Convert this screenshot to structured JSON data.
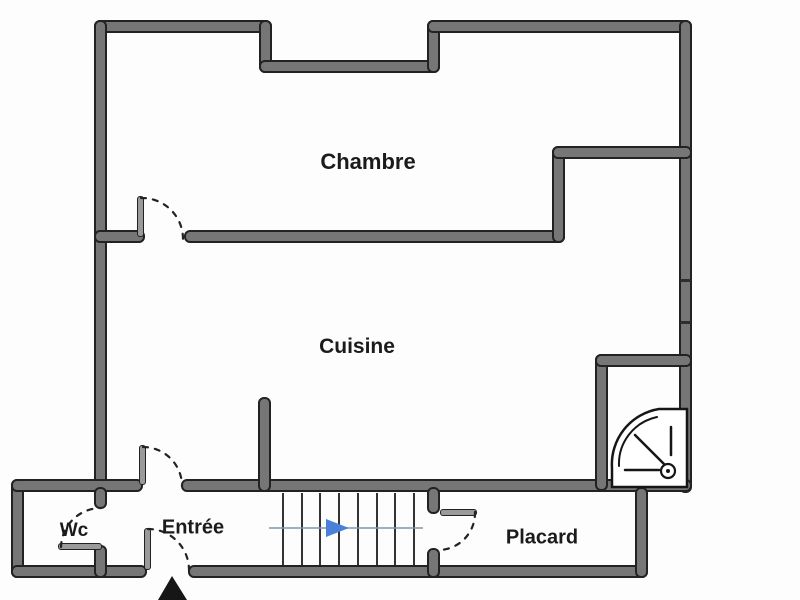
{
  "plan": {
    "type": "floor-plan",
    "background_color": "#fdfdfd",
    "wall_fill_color": "#767676",
    "wall_edge_color": "#222222",
    "rooms": [
      {
        "id": "chambre",
        "label": "Chambre"
      },
      {
        "id": "cuisine",
        "label": "Cuisine"
      },
      {
        "id": "entree",
        "label": "Entrée"
      },
      {
        "id": "wc",
        "label": "Wc"
      },
      {
        "id": "placard",
        "label": "Placard"
      }
    ],
    "stairs": {
      "tread_count": 9,
      "direction": "right",
      "arrow_color": "#4a80d9",
      "guide_line_color": "#8295ab"
    },
    "doors": [
      {
        "room": "chambre",
        "style": "dashed-swing-arc"
      },
      {
        "room": "cuisine",
        "style": "dashed-swing-arc"
      },
      {
        "room": "wc",
        "style": "dashed-swing-arc"
      },
      {
        "room": "entree",
        "style": "dashed-swing-arc"
      },
      {
        "room": "placard",
        "style": "dashed-swing-arc"
      }
    ],
    "icons": [
      {
        "name": "shower-icon",
        "location": "top-right-bathroom"
      },
      {
        "name": "entrance-arrow-icon",
        "location": "bottom-entrance"
      }
    ]
  }
}
